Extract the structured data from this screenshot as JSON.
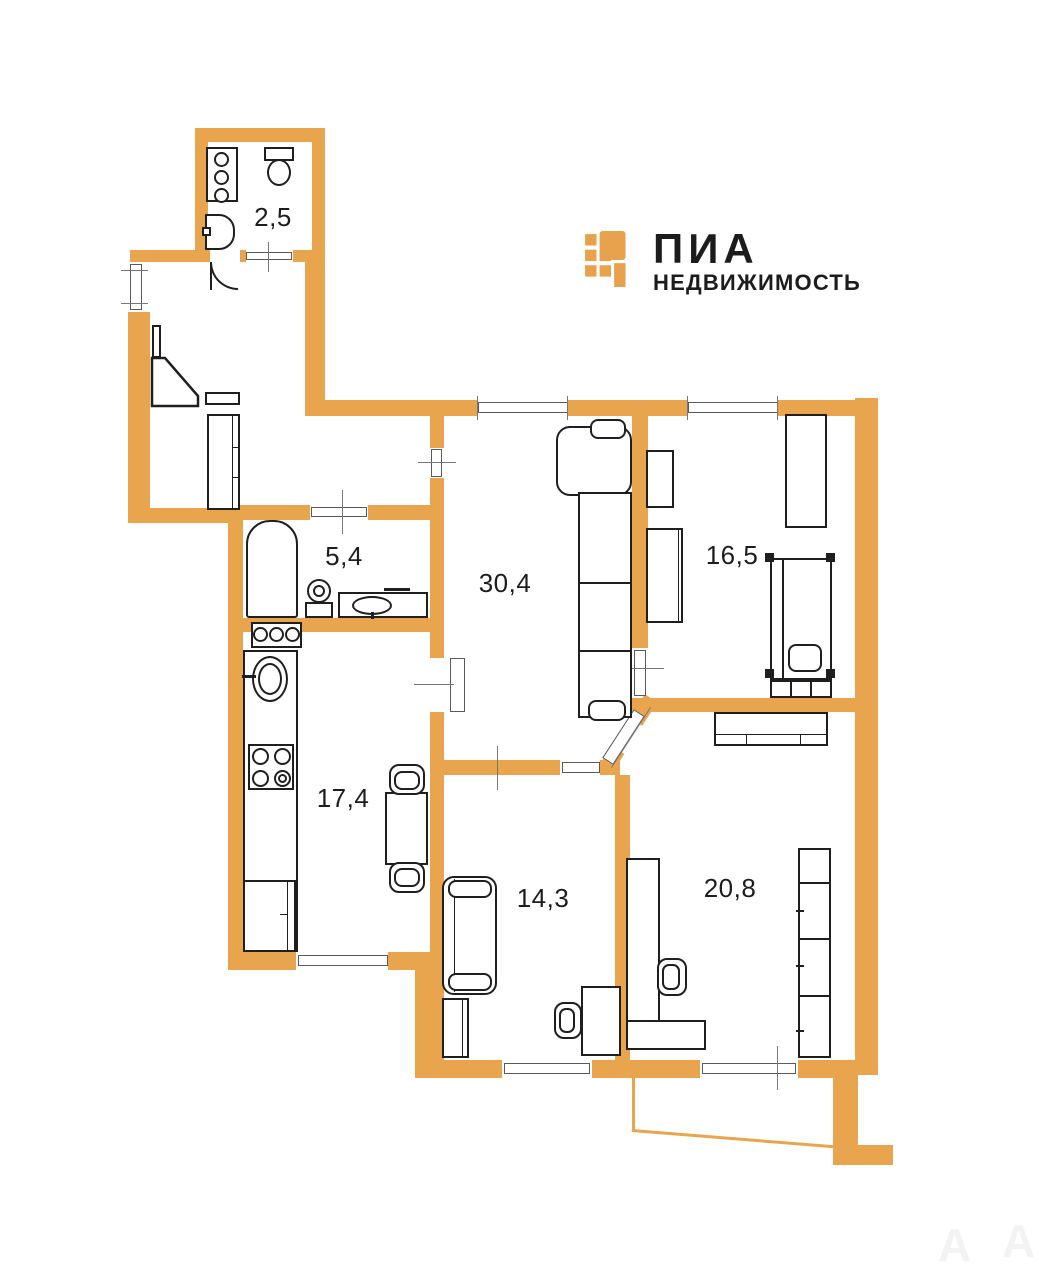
{
  "brand": {
    "name": "ПИА",
    "tagline": "НЕДВИЖИМОСТЬ",
    "accent_color": "#E8A14C",
    "text_color": "#1C1C1C"
  },
  "plan": {
    "wall_color": "#E9A54E",
    "line_color": "#1F1F1F",
    "rooms": [
      {
        "id": "wc",
        "area": "2,5"
      },
      {
        "id": "bathroom",
        "area": "5,4"
      },
      {
        "id": "living",
        "area": "30,4"
      },
      {
        "id": "bedroom",
        "area": "16,5"
      },
      {
        "id": "kitchen",
        "area": "17,4"
      },
      {
        "id": "room-14",
        "area": "14,3"
      },
      {
        "id": "room-20",
        "area": "20,8"
      }
    ],
    "watermark": [
      "А",
      "А"
    ]
  }
}
